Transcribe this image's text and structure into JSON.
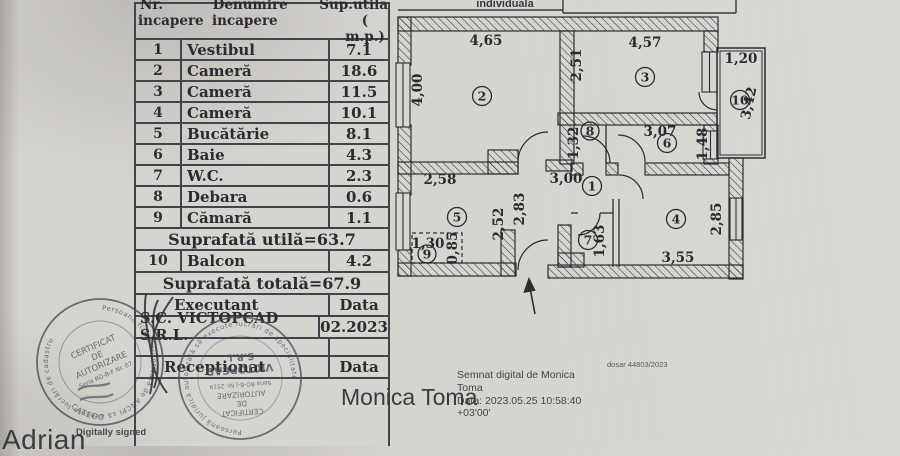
{
  "doc": {
    "top_partial_label": "individuala",
    "dosar_note": "dosar 44803/2023"
  },
  "table": {
    "header": {
      "nr1": "Nr.",
      "nr2": "incapere",
      "den1": "Denumire",
      "den2": "incapere",
      "sup1": "Sup.utila",
      "sup2": "( m.p.)"
    },
    "rows": [
      {
        "nr": "1",
        "name": "Vestibul",
        "area": "7.1"
      },
      {
        "nr": "2",
        "name": "Cameră",
        "area": "18.6"
      },
      {
        "nr": "3",
        "name": "Cameră",
        "area": "11.5"
      },
      {
        "nr": "4",
        "name": "Cameră",
        "area": "10.1"
      },
      {
        "nr": "5",
        "name": "Bucătărie",
        "area": "8.1"
      },
      {
        "nr": "6",
        "name": "Baie",
        "area": "4.3"
      },
      {
        "nr": "7",
        "name": "W.C.",
        "area": "2.3"
      },
      {
        "nr": "8",
        "name": "Debara",
        "area": "0.6"
      },
      {
        "nr": "9",
        "name": "Cămară",
        "area": "1.1"
      }
    ],
    "subtotal": "Suprafată utilă=63.7",
    "balcon": {
      "nr": "10",
      "name": "Balcon",
      "area": "4.2"
    },
    "total": "Suprafată totală=67.9",
    "exec_label": "Executant",
    "exec_data": "Data",
    "exec_company": "S.C. VICTOPCAD S.R.L.",
    "exec_date": "02.2023",
    "recv_label": "Recepționat",
    "recv_data": "Data"
  },
  "plan": {
    "rooms": {
      "r1": "1",
      "r2": "2",
      "r3": "3",
      "r4": "4",
      "r5": "5",
      "r6": "6",
      "r7": "7",
      "r8": "8",
      "r9": "9",
      "r10": "10"
    },
    "dims": {
      "top_room2": "4,65",
      "left_room2": "4,00",
      "top_room3": "4,57",
      "left_room3": "2,51",
      "balcony_w": "1,20",
      "balcony_h": "3,42",
      "debara_h": "1,32",
      "baie_w": "3,07",
      "baie_h": "1,48",
      "kitchen_w": "2,58",
      "vestibul_w": "3,00",
      "hall_a": "2,83",
      "hall_b": "2,52",
      "camara_w": "1,30",
      "camara_h": "0,85",
      "wc_h": "1,63",
      "room4_w": "3,55",
      "room4_h": "2,85"
    }
  },
  "stamps": {
    "left": {
      "ring": "Persoană fizică autorizată de ANCPI să execute lucrări de cadastru",
      "l1": "CERTIFICAT",
      "l2": "DE",
      "l3": "AUTORIZARE",
      "l4": "Seria RO-B-F Nr. 07",
      "arc": "CATEGO"
    },
    "right": {
      "ring": "Persoană juridică autorizată să execute lucrări de specialitate",
      "l1": "CERTIFICAT",
      "l2": "DE",
      "l3": "AUTORIZARE",
      "l4": "Seria RO-B-J Nr. 2519",
      "l5": "VICTOPCAD",
      "l6": "S.R.L."
    }
  },
  "signatures": {
    "adrian": {
      "name": "Adrian",
      "note": "Digitally signed"
    },
    "monica": {
      "name": "Monica Toma",
      "l1": "Semnat digital de Monica",
      "l2": "Toma",
      "l3": "Data: 2023.05.25 10:58:40",
      "l4": "+03'00'"
    }
  }
}
